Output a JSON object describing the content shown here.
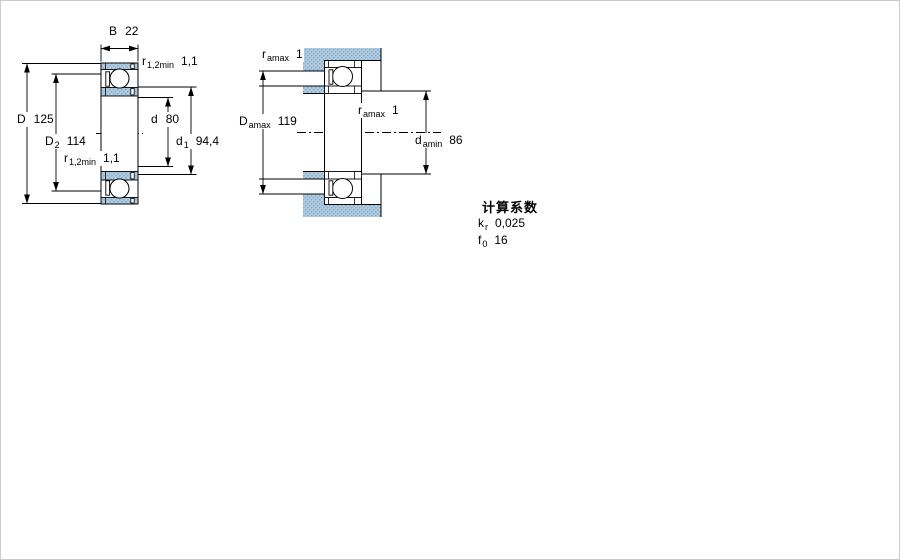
{
  "colors": {
    "background": "#ffffff",
    "line": "#000000",
    "section_fill_base": "#b4cde0",
    "section_fill_dot": "#7fa9c9"
  },
  "left_diagram": {
    "description": "bearing cross-section with boundary dimensions",
    "dims": {
      "B": {
        "sym": "B",
        "sub": "",
        "val": "22"
      },
      "r_top": {
        "sym": "r",
        "sub": "1,2min",
        "val": "1,1"
      },
      "D": {
        "sym": "D",
        "sub": "",
        "val": "125"
      },
      "D2": {
        "sym": "D",
        "sub": "2",
        "val": "114"
      },
      "d": {
        "sym": "d",
        "sub": "",
        "val": "80"
      },
      "d1": {
        "sym": "d",
        "sub": "1",
        "val": "94,4"
      },
      "r_bottom": {
        "sym": "r",
        "sub": "1,2min",
        "val": "1,1"
      }
    }
  },
  "right_diagram": {
    "description": "mounted bearing with abutment dimensions",
    "dims": {
      "r_top": {
        "sym": "r",
        "sub": "amax",
        "val": "1"
      },
      "Damax": {
        "sym": "D",
        "sub": "amax",
        "val": "119"
      },
      "r_mid": {
        "sym": "r",
        "sub": "amax",
        "val": "1"
      },
      "damin": {
        "sym": "d",
        "sub": "amin",
        "val": "86"
      }
    }
  },
  "factors": {
    "title": "计算系数",
    "rows": [
      {
        "sym": "k",
        "sub": "r",
        "val": "0,025"
      },
      {
        "sym": "f",
        "sub": "0",
        "val": "16"
      }
    ]
  }
}
